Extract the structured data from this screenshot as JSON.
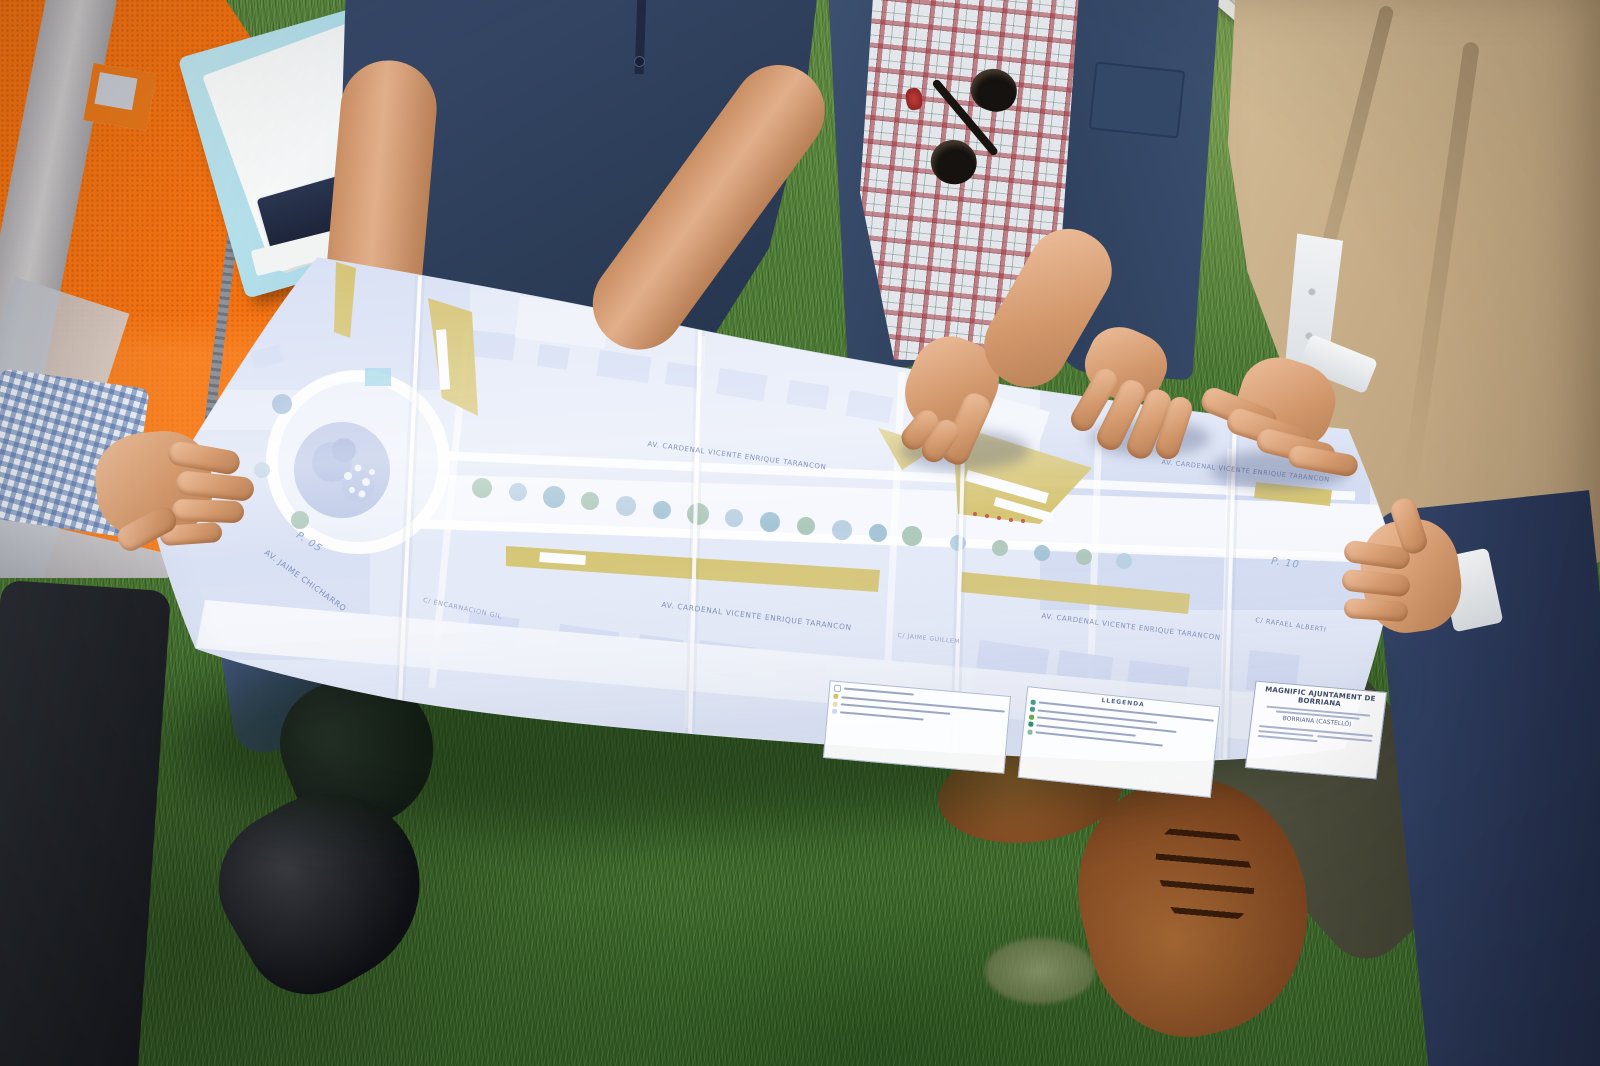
{
  "scene": {
    "environment": "people standing on grass lawn beside a road, holding a large printed urban plan",
    "colors": {
      "grass": "#4f7c36",
      "road": "#a9adaa",
      "curb": "#e6e7e0",
      "vest_orange": "#f2700f",
      "vest_stripe": "#b7bac2",
      "polo_navy": "#2c3d58",
      "jacket_navy": "#35486b",
      "plaid_red": "#9c2c36",
      "blazer_beige": "#c2a882",
      "folder_blue": "#9ed2e2",
      "paper_white": "#f4f6fb",
      "map_water": "#b9c6e6",
      "map_building": "#d2dcf3",
      "map_tan": "#d2bf69",
      "skin": "#d9a183",
      "shoe_brown": "#7c441f",
      "shoe_black": "#17181c",
      "jeans_navy": "#2c3950"
    }
  },
  "plan": {
    "street_labels": [
      {
        "text": "AV. CARDENAL VICENTE ENRIQUE TARANCON"
      },
      {
        "text": "AV. CARDENAL VICENTE ENRIQUE TARANCON"
      },
      {
        "text": "AV. CARDENAL VICENTE ENRIQUE TARANCON"
      },
      {
        "text": "AV. CARDENAL VICENTE ENRIQUE TARANCON"
      },
      {
        "text": "AV. JAIME CHICHARRO"
      },
      {
        "text": "C/ ENCARNACION GIL"
      },
      {
        "text": "C/ JAIME GUILLEM"
      },
      {
        "text": "C/ RAFAEL ALBERTI"
      }
    ],
    "markers": [
      {
        "text": "P. 05"
      },
      {
        "text": "P. 10"
      }
    ],
    "legend": {
      "title": "LLEGENDA"
    },
    "title_block": {
      "org": "MAGNIFIC AJUNTAMENT DE BORRIANA",
      "location": "BORRIANA (CASTELLÓ)"
    }
  }
}
